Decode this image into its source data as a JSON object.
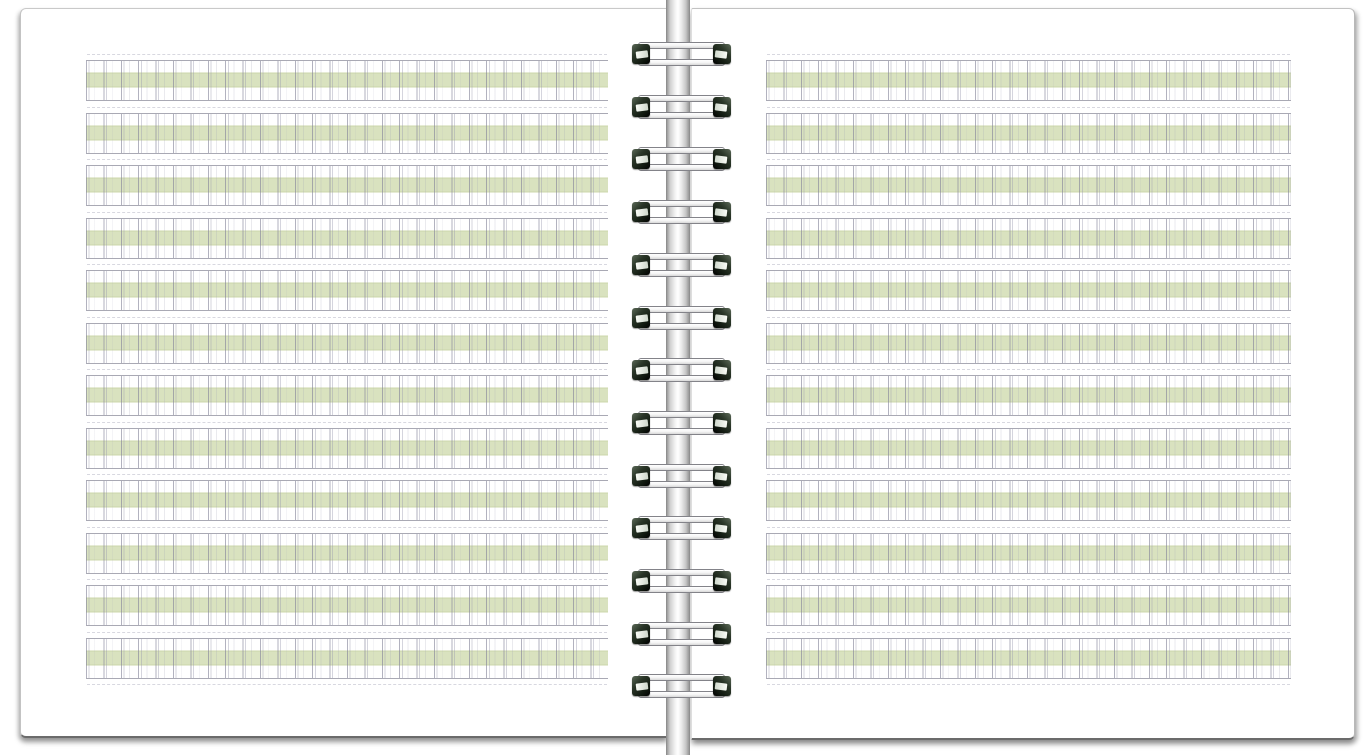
{
  "image": {
    "subject": "open-spiral-notebook-with-writing-practice-grid",
    "visible_text": "",
    "orientation": "two-page spread"
  },
  "left_page": {
    "row_count": 12,
    "cells_per_row": 30,
    "row_style": "four-line grid with green middle band"
  },
  "right_page": {
    "row_count": 12,
    "cells_per_row": 30,
    "row_style": "four-line grid with green middle band"
  },
  "binding": {
    "loop_count": 13,
    "style": "twin-loop wire over metallic spine bar"
  },
  "colors": {
    "backdrop": "#ffffff",
    "paper": "#ffffff",
    "band": "#d9e2bf",
    "band_edge": "#ccd7ab",
    "row_border": "#a9a9b4",
    "grid_line_strong": "rgba(130,130,152,0.62)",
    "grid_line_light": "rgba(150,150,172,0.40)",
    "grid_line_faint": "rgba(160,160,180,0.22)",
    "dash_line": "#d8d8e0",
    "page_edge_shadow": "#6b6b6b",
    "wire_end": "#10180f",
    "spine_highlight": "#ffffff"
  },
  "layout_counts": {
    "pages": 2
  }
}
